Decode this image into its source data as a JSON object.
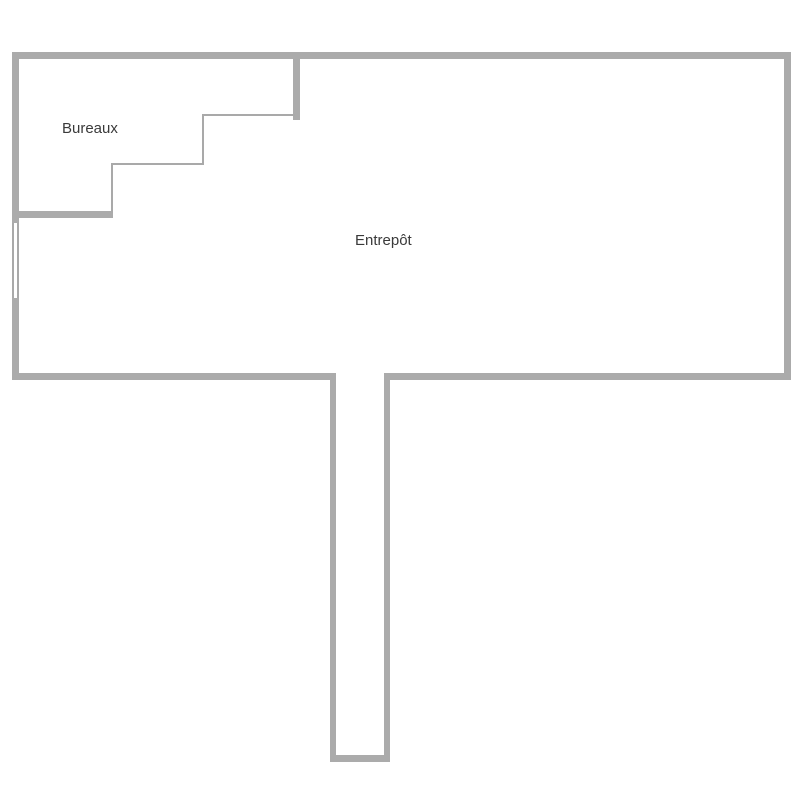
{
  "document": {
    "type": "floor-plan",
    "language": "fr"
  },
  "colors": {
    "wall": "#ababab",
    "thin_line": "#a9a9a9",
    "label_text": "#3a3a3a",
    "page_bg": "#ffffff"
  },
  "floorplan": {
    "rooms": [
      {
        "id": "bureaux",
        "label": "Bureaux"
      },
      {
        "id": "entrepot",
        "label": "Entrepôt"
      }
    ],
    "features": [
      "stepped-partition-between-bureaux-and-entrepot",
      "window-on-left-wall",
      "corridor-extending-down-from-bottom-wall"
    ]
  }
}
